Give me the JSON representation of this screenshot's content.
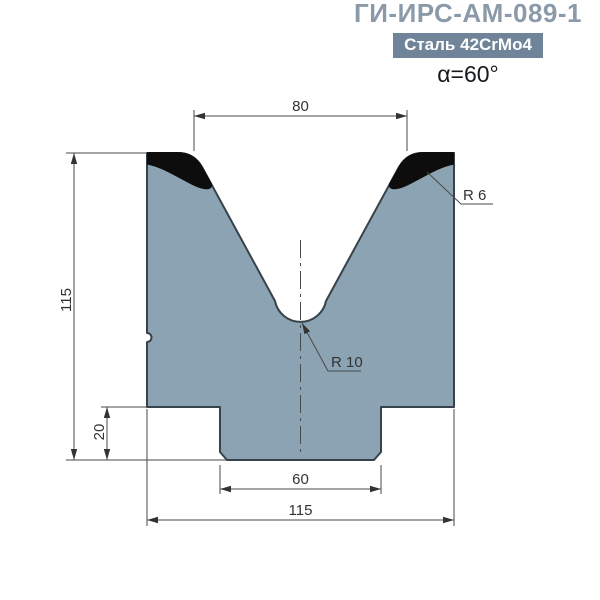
{
  "header": {
    "title": "ГИ-ИРС-АМ-089-1",
    "material_badge": "Сталь 42CrMo4",
    "angle": "α=60°"
  },
  "drawing": {
    "dimensions": {
      "groove_opening_width": "80",
      "die_height": "115",
      "tang_height": "20",
      "tang_width": "60",
      "die_width": "115",
      "shoulder_radius_label": "R 6",
      "groove_bottom_radius_label": "R 10"
    },
    "colors": {
      "title_text": "#8b9aa9",
      "badge_background": "#6f8498",
      "badge_text": "#ffffff",
      "die_fill": "#8ba3b2",
      "die_outline": "#38424a",
      "hardened_zone": "#0d0d0d",
      "dimension_lines": "#4a4a4a",
      "dimension_text": "#333333"
    }
  }
}
